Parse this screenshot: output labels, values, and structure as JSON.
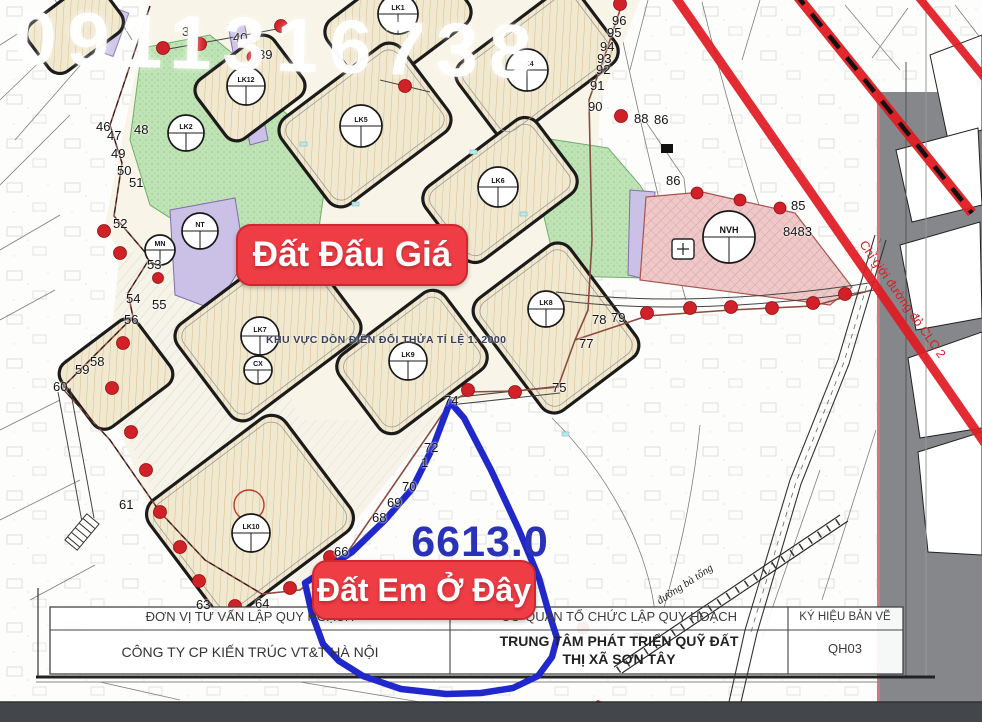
{
  "watermark": "0911316738",
  "badges": {
    "auction": "Đất Đấu Giá",
    "here": "Đất Em Ở Đây"
  },
  "area_label": "6613.0",
  "zone_note": "KHU VỰC DỒN ĐIỀN ĐỔI THỬA TỈ LỆ 1: 2000",
  "red_boundary_note": "Chỉ giới đường đỏ CLC 2",
  "road_label": "đường bà tổng",
  "title_block": {
    "col1_header": "ĐƠN VỊ TƯ VẤN LẬP QUY HOẠCH",
    "col1_value": "CÔNG TY CP KIẾN TRÚC VT&T HÀ NỘI",
    "col2_header": "CƠ QUAN TỔ CHỨC LẬP QUY HOẠCH",
    "col2_value_line1": "TRUNG TÂM PHÁT TRIỂN QUỸ ĐẤT",
    "col2_value_line2": "THỊ XÃ SƠN TÂY",
    "col3_header": "KÝ HIỆU BẢN VẼ",
    "col3_value": "QH03"
  },
  "colors": {
    "badge_red": "#ee3d45",
    "parcel_outline_blue": "#2028cc",
    "area_text_blue": "#2a33b8",
    "red_planning_line": "#e01b22",
    "boundary_dot_red": "#cf2127",
    "block_tan": "#f1e8d0",
    "park_green": "#bfe3b4",
    "culture_pink": "#efc9c9",
    "school_purple": "#cbc0e6"
  },
  "map": {
    "point_numbers": [
      {
        "t": "3",
        "x": 182,
        "y": 24
      },
      {
        "t": "40",
        "x": 233,
        "y": 30
      },
      {
        "t": "39",
        "x": 258,
        "y": 47
      },
      {
        "t": "46",
        "x": 96,
        "y": 119
      },
      {
        "t": "47",
        "x": 107,
        "y": 128
      },
      {
        "t": "48",
        "x": 134,
        "y": 122
      },
      {
        "t": "49",
        "x": 111,
        "y": 146
      },
      {
        "t": "50",
        "x": 117,
        "y": 163
      },
      {
        "t": "51",
        "x": 129,
        "y": 175
      },
      {
        "t": "52",
        "x": 113,
        "y": 216
      },
      {
        "t": "53",
        "x": 147,
        "y": 257
      },
      {
        "t": "54",
        "x": 126,
        "y": 291
      },
      {
        "t": "55",
        "x": 152,
        "y": 297
      },
      {
        "t": "56",
        "x": 124,
        "y": 312
      },
      {
        "t": "58",
        "x": 90,
        "y": 354
      },
      {
        "t": "59",
        "x": 75,
        "y": 362
      },
      {
        "t": "60",
        "x": 53,
        "y": 379
      },
      {
        "t": "61",
        "x": 119,
        "y": 497
      },
      {
        "t": "63",
        "x": 196,
        "y": 597
      },
      {
        "t": "64",
        "x": 255,
        "y": 596
      },
      {
        "t": "74",
        "x": 444,
        "y": 393
      },
      {
        "t": "72",
        "x": 424,
        "y": 440
      },
      {
        "t": "1",
        "x": 421,
        "y": 455
      },
      {
        "t": "70",
        "x": 402,
        "y": 479
      },
      {
        "t": "69",
        "x": 387,
        "y": 495
      },
      {
        "t": "68",
        "x": 372,
        "y": 510
      },
      {
        "t": "66",
        "x": 334,
        "y": 544
      },
      {
        "t": "75",
        "x": 552,
        "y": 380
      },
      {
        "t": "96",
        "x": 612,
        "y": 13
      },
      {
        "t": "95",
        "x": 607,
        "y": 25
      },
      {
        "t": "94",
        "x": 600,
        "y": 39
      },
      {
        "t": "93",
        "x": 597,
        "y": 51
      },
      {
        "t": "92",
        "x": 596,
        "y": 62
      },
      {
        "t": "91",
        "x": 590,
        "y": 78
      },
      {
        "t": "90",
        "x": 588,
        "y": 99
      },
      {
        "t": "88",
        "x": 634,
        "y": 111
      },
      {
        "t": "86",
        "x": 654,
        "y": 112
      },
      {
        "t": "86",
        "x": 666,
        "y": 173
      },
      {
        "t": "85",
        "x": 791,
        "y": 198
      },
      {
        "t": "8483",
        "x": 783,
        "y": 224
      },
      {
        "t": "78",
        "x": 592,
        "y": 312
      },
      {
        "t": "79",
        "x": 611,
        "y": 310
      },
      {
        "t": "77",
        "x": 579,
        "y": 336
      }
    ],
    "lot_symbols": [
      {
        "t": "LK1",
        "x": 398,
        "y": 14,
        "r": 20
      },
      {
        "t": "LK4",
        "x": 527,
        "y": 70,
        "r": 21
      },
      {
        "t": "LK12",
        "x": 246,
        "y": 86,
        "r": 19
      },
      {
        "t": "LK2",
        "x": 186,
        "y": 133,
        "r": 18
      },
      {
        "t": "LK5",
        "x": 361,
        "y": 126,
        "r": 21
      },
      {
        "t": "LK6",
        "x": 498,
        "y": 187,
        "r": 20
      },
      {
        "t": "NT",
        "x": 200,
        "y": 231,
        "r": 18
      },
      {
        "t": "MN",
        "x": 160,
        "y": 250,
        "r": 15
      },
      {
        "t": "LK7",
        "x": 260,
        "y": 336,
        "r": 19
      },
      {
        "t": "CX",
        "x": 258,
        "y": 370,
        "r": 14
      },
      {
        "t": "LK9",
        "x": 408,
        "y": 361,
        "r": 19
      },
      {
        "t": "LK8",
        "x": 546,
        "y": 309,
        "r": 18
      },
      {
        "t": "LK10",
        "x": 251,
        "y": 533,
        "r": 19
      },
      {
        "t": "NVH",
        "x": 729,
        "y": 237,
        "r": 26
      }
    ]
  }
}
